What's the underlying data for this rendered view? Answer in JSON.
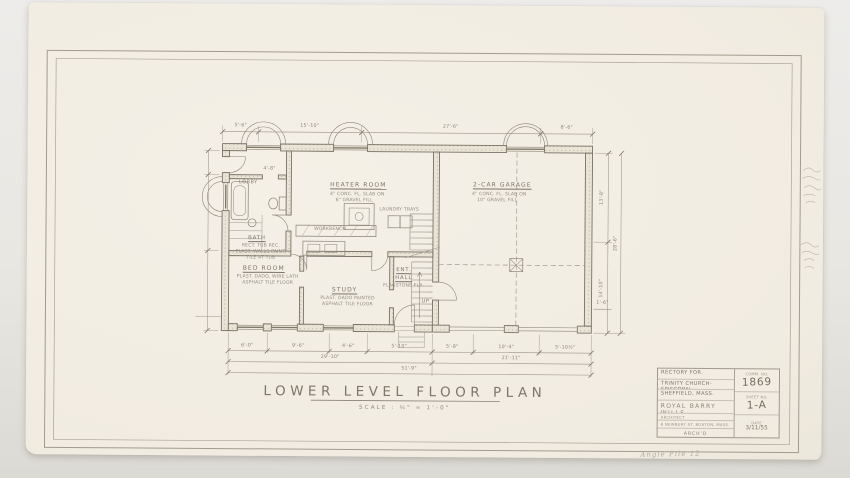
{
  "surface": {
    "background": "#e8e6e1",
    "paper": "#f2eee4",
    "pencil": "#8a8478"
  },
  "titles": {
    "main": "LOWER LEVEL FLOOR PLAN",
    "scale": "SCALE : ¼\" = 1'-0\"",
    "handwritten_note": "Angle File 12"
  },
  "title_block": {
    "line1": "RECTORY FOR.",
    "line2": "TRINITY CHURCH-EPISCOPAL",
    "line3": "SHEFFIELD, MASS.",
    "firm": "ROYAL BARRY WILLS",
    "firm_sub": "ARCHITECT",
    "firm_addr": "8 NEWBURY ST. BOSTON, MASS.",
    "archd": "ARCH'D",
    "comm_label": "COMM. NO.",
    "comm_no": "1869",
    "sheet_label": "SHEET NO.",
    "sheet_no": "1-A",
    "date_label": "DATE",
    "date": "3/11/55"
  },
  "plan": {
    "rooms": {
      "lobby": "LOBBY",
      "bath": "BATH",
      "bath_notes": [
        "RECT. TUB REC.",
        "PLAST. WALLS PAINT.",
        "TILE AT TUB"
      ],
      "heater": "HEATER ROOM",
      "heater_notes": [
        "4\" CONC. FL. SLAB ON",
        "6\" GRAVEL FILL"
      ],
      "garage": "2-CAR GARAGE",
      "garage_notes": [
        "4\" CONC. FL. SLAB ON",
        "10\" GRAVEL FILL"
      ],
      "bedroom": "BED ROOM",
      "bedroom_notes": [
        "PLAST. DADO, WIRE LATH",
        "ASPHALT TILE FLOOR"
      ],
      "study": "STUDY",
      "study_notes": [
        "PLAST. DADO PAINTED",
        "ASPHALT TILE FLOOR"
      ],
      "ent1": "ENT.",
      "ent2": "HALL",
      "ent_note": "FLAGSTONE FLR.",
      "workbench": "WORKBENCH",
      "laundry": "LAUNDRY TRAYS",
      "up": "UP",
      "dim_interior": "4'-8\""
    },
    "dims": {
      "top": [
        "5'-6\"",
        "15'-10\"",
        "27'-6\"",
        "8'-6\""
      ],
      "bottom": [
        "6'-0\"",
        "9'-6\"",
        "4'-6\"",
        "5'-10\"",
        "5'-8\"",
        "10'-4\"",
        "5'-10½\""
      ],
      "totals": [
        "29'-10\"",
        "21'-11\""
      ],
      "overall": "51'-9\"",
      "right": [
        "13'-8\"",
        "14'-10\""
      ],
      "right_overall": "28'-6\"",
      "small": "1'-6\""
    }
  }
}
